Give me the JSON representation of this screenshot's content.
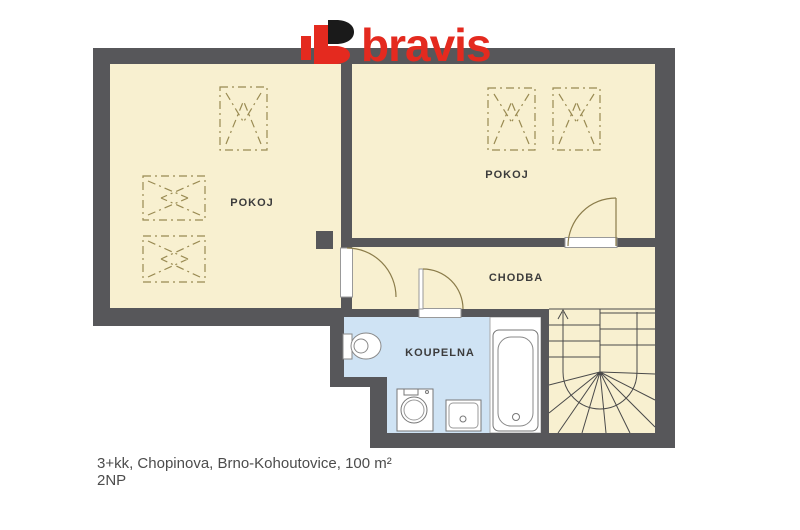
{
  "logo": {
    "text": "bravis",
    "accent_color": "#e42a1f"
  },
  "plan": {
    "rooms": {
      "pokoj_left": "POKOJ",
      "pokoj_right": "POKOJ",
      "chodba": "CHODBA",
      "koupelna": "KOUPELNA"
    },
    "colors": {
      "wall": "#57575a",
      "room_fill": "#f8f0d0",
      "bathroom_fill": "#cfe3f4",
      "fixture_zone_fill": "#ffffff",
      "furniture_dash_line": "#998a52",
      "door_line": "#8b7c4a",
      "stair_line": "#4a4a4a"
    }
  },
  "caption": {
    "line1": "3+kk, Chopinova, Brno-Kohoutovice, 100 m²",
    "line2": "2NP"
  }
}
